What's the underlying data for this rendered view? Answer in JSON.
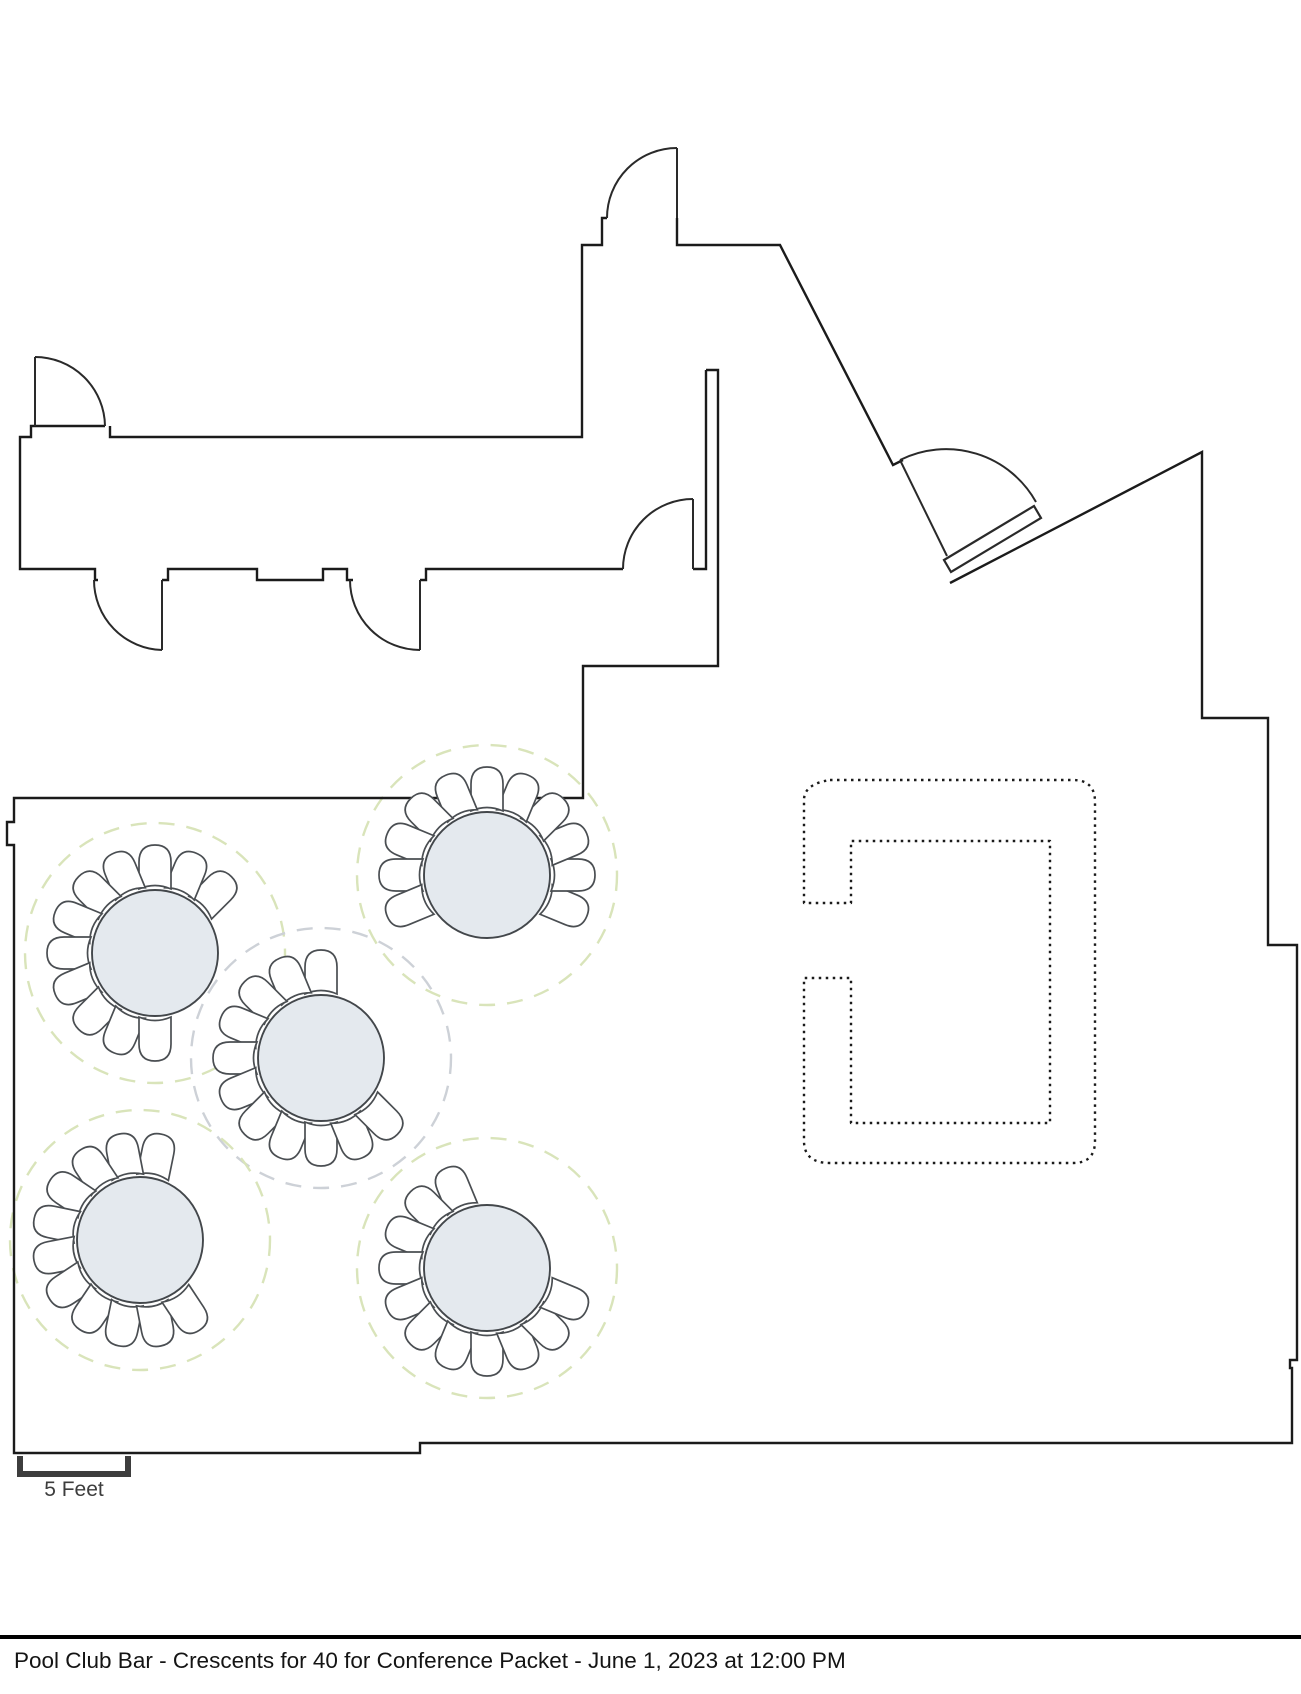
{
  "footer": {
    "title": "Pool Club Bar - Crescents for 40 for Conference Packet - June 1, 2023 at 12:00 PM"
  },
  "scale_bar": {
    "label": "5 Feet",
    "x1": 20,
    "x2": 128,
    "y_base": 1474,
    "y_top": 1456,
    "label_x": 74,
    "label_y": 1496
  },
  "colors": {
    "wall": "#1b1b1b",
    "door": "#2a2a2a",
    "table_fill": "#e4e9ee",
    "table_stroke": "#43474b",
    "chair_stroke": "#4a4e52",
    "chair_fill": "#ffffff",
    "spacing_green": "#d9e4ba",
    "spacing_grey": "#cdd1d7",
    "bar_dot": "#1b1b1b",
    "scale_stroke": "#3d3d3d",
    "text": "#141414"
  },
  "floorplan": {
    "walls": [
      "M706,370 L718,370 L718,666 L583,666 L583,798 L14,798 L14,822 L7,822 L7,845 L14,845 L14,1453 L420,1453 L420,1443 L1292,1443 L1292,1368 L1290,1368 L1290,1360 L1297,1360 L1297,945 L1268,945 L1268,718 L1202,718 L1202,452 L950,583",
      "M706,370 L706,569 L693,569",
      "M105,426 L31,426 L31,437 L20,437 L20,569 L95,569 L95,580 L98,580",
      "M110,426 L110,437 L582,437 L582,245 L602,245 L602,218 L607,218",
      "M162,580 L168,580 L168,569 L257,569 L257,580 L323,580 L323,569 L347,569 L347,580 L353,580",
      "M420,580 L426,580 L426,569 L623,569",
      "M677,218 L677,245 L780,245 L893,465 L903,460"
    ],
    "door_panels": [
      "M35,357 L35,426",
      "M677,148 L677,218",
      "M162,580 L162,650",
      "M420,580 L420,650",
      "M693,499 L693,569",
      "M900,460 L947,556"
    ],
    "door_arcs": [
      "M35,357 A70,70 0 0 1 105,426",
      "M607,218 A70,70 0 0 1 677,148",
      "M162,650 A70,70 0 0 1 94,580",
      "M420,650 A70,70 0 0 1 350,580",
      "M623,569 A70,70 0 0 1 693,499",
      "M900,460 A103,103 0 0 1 1036,502"
    ],
    "door_polygons": [
      "944,560 1034,506 1041,518 951,572"
    ],
    "bar": {
      "path": "M830,780 L1073,780 Q1095,780 1095,802 L1095,1141 Q1095,1163 1073,1163 L830,1163 Q804,1163 804,1141 L804,978 L851,978 L851,1123 L1050,1123 L1050,841 L851,841 L851,903 L804,903 L804,800 Q804,784 830,780 Z"
    },
    "table_radius": 63,
    "ring_radius": 130,
    "chair_count": 11,
    "chair_step_deg": 22.5,
    "chair_gap_half_deg": 67.5,
    "chair_offset": 80,
    "chair_path": "M-16,16 L-16,-11 Q-16,-28 0,-28 Q16,-28 16,-11 L16,16 Q0,9 -16,16 Z",
    "tables": [
      {
        "id": 1,
        "cx": 155,
        "cy": 953,
        "gap_deg": -22.5,
        "ring": "green"
      },
      {
        "id": 2,
        "cx": 487,
        "cy": 875,
        "gap_deg": -90,
        "ring": "green"
      },
      {
        "id": 3,
        "cx": 321,
        "cy": 1058,
        "gap_deg": 22.5,
        "ring": "grey"
      },
      {
        "id": 4,
        "cx": 140,
        "cy": 1240,
        "gap_deg": 11,
        "ring": "green"
      },
      {
        "id": 5,
        "cx": 487,
        "cy": 1268,
        "gap_deg": 45,
        "ring": "green"
      }
    ]
  }
}
